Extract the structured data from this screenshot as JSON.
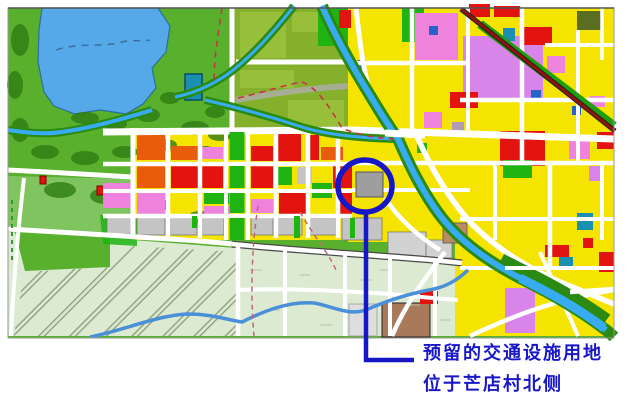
{
  "figure": {
    "annotation": {
      "line1": "预留的交通设施用地",
      "line2": "位于芒店村北侧",
      "color": "#1717c8"
    },
    "highlight_color": "#1717c8",
    "palette": {
      "park": "#58b02c",
      "park_light": "#7fc45f",
      "trees": "#2e7d12",
      "lake": "#55a9e8",
      "water": "#38acf2",
      "river_bank": "#2b8a12",
      "field": "#84b02c",
      "field_light": "#98bf3a",
      "residential": "#f5e400",
      "commercial_pink": "#ee82dd",
      "violet": "#d884e8",
      "red": "#e31410",
      "orange": "#e85c0c",
      "green_space": "#1fb412",
      "gray": "#c4c4c4",
      "village": "#dcead2",
      "road": "#ffffff",
      "railway": "#8e140c",
      "rail_buffer": "#1f9e10",
      "blue_parcel": "#2663c9",
      "teal": "#1b8fb0",
      "brown": "#a9795b",
      "dark_olive": "#5a6e22",
      "hatch_line": "#8a9a76",
      "boundary_dash_red": "#cc3344",
      "boundary_dash_green": "#2e9e2e"
    }
  }
}
